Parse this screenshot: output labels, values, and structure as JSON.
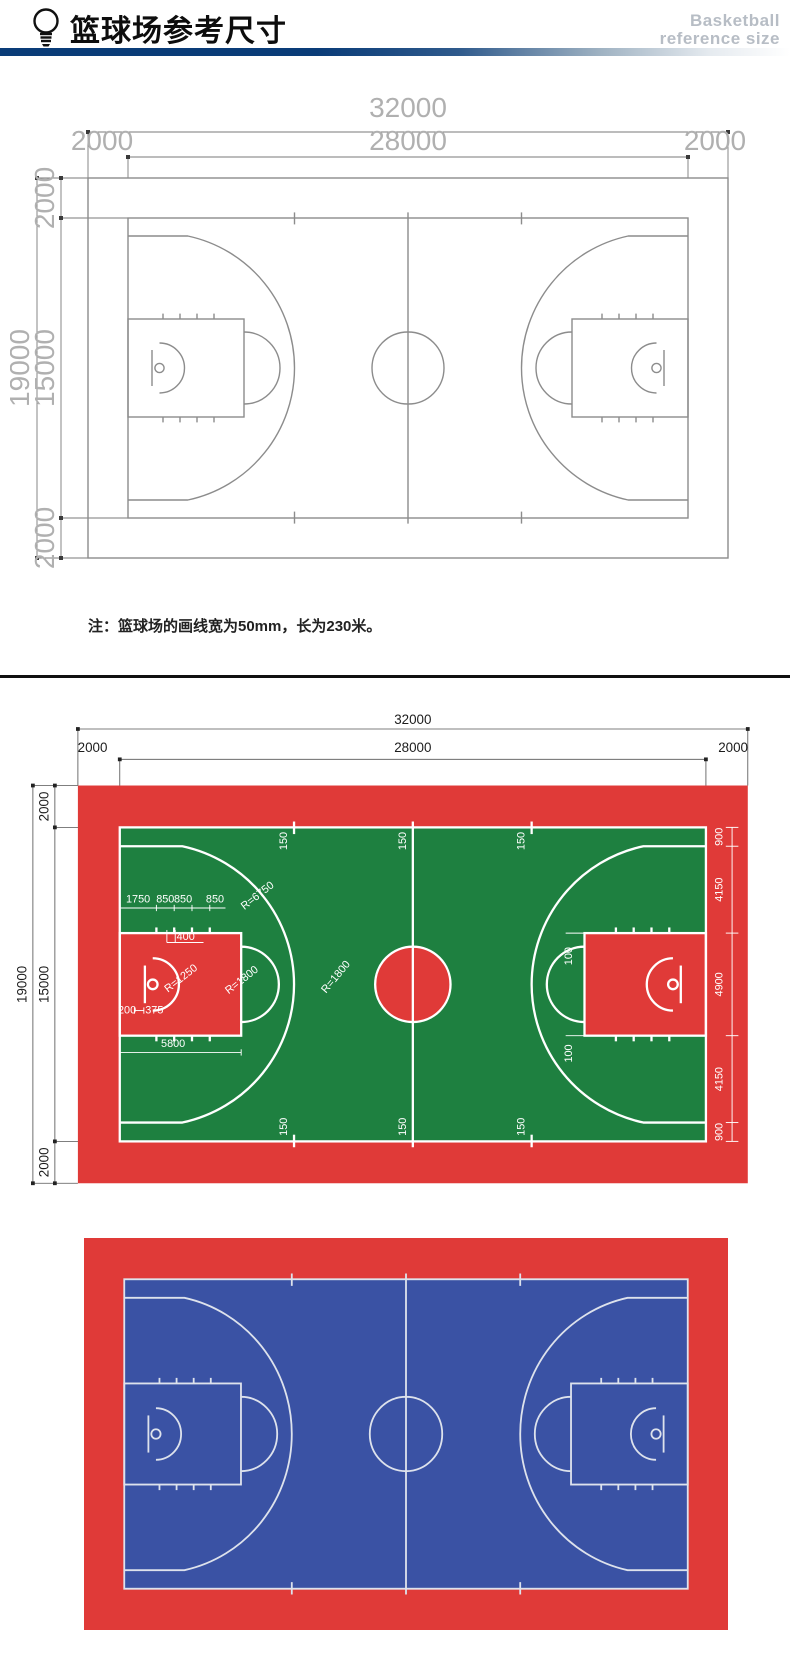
{
  "header": {
    "icon": "lightbulb-icon",
    "title": "篮球场参考尺寸",
    "subtitle_line1": "Basketball",
    "subtitle_line2": "reference size"
  },
  "note": "注：篮球场的画线宽为50mm，长为230米。",
  "colors": {
    "navy_bar": "#0a3c78",
    "red": "#e03a38",
    "green": "#1e8040",
    "blue": "#3a52a4",
    "court_line_white": "#ffffff",
    "court_line_gray": "#8c8c8c",
    "court_line_light": "#dde2ec"
  },
  "d1": {
    "top_total": "32000",
    "top_inner": "28000",
    "top_left": "2000",
    "top_right": "2000",
    "side_total": "19000",
    "side_inner": "15000",
    "side_top": "2000",
    "side_bottom": "2000"
  },
  "d2": {
    "top_total": "32000",
    "top_inner": "28000",
    "top_left": "2000",
    "top_right": "2000",
    "side_total": "19000",
    "side_inner": "15000",
    "side_top": "2000",
    "side_bottom": "2000",
    "right_segments": [
      "900",
      "4150",
      "4900",
      "4150",
      "900"
    ],
    "ticks_top": [
      "150",
      "150",
      "150"
    ],
    "ticks_bottom": [
      "150",
      "150",
      "150"
    ],
    "lane_segments": [
      "1750",
      "850",
      "850",
      "850"
    ],
    "backboard_offset": "400",
    "no_charge_radius": "R=1250",
    "free_throw_radius": "R=1800",
    "three_point_radius": "R=6750",
    "center_radius": "R=1800",
    "rim_offset_a": "200",
    "rim_offset_b": "375",
    "key_length": "5800",
    "lane_mark_top": "100",
    "lane_mark_bottom": "100"
  }
}
